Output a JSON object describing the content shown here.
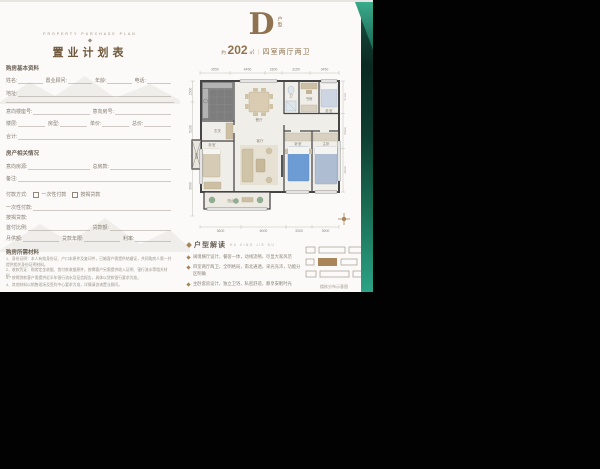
{
  "page": {
    "background": "#fbfaf8",
    "backdrop": "#020202",
    "accent_teal_dark": "#0a2921",
    "accent_teal_bright": "#2ca487",
    "accent_gold": "#a8865a"
  },
  "form": {
    "brand": "PROPERTY PURCHASE PLAN",
    "title": "置业计划表",
    "basic": {
      "section": "购房基本资料",
      "f_name": "姓名:",
      "f_consultant": "置业顾问:",
      "f_age": "年龄:",
      "f_phone": "电话:",
      "f_address": "地址:",
      "f_block": "意向楼座号:",
      "f_room": "意向房号:",
      "f_floor": "楼层:",
      "f_type": "房型:",
      "f_unitprice": "单价:",
      "f_total": "总价:",
      "f_sum": "合计:"
    },
    "property": {
      "section": "房产相关情况",
      "f_intent": "意向房源:",
      "f_amount": "总房款:",
      "f_note": "备注:"
    },
    "payment": {
      "label": "付款方式:",
      "opt1": "一次性付款",
      "opt2": "按揭贷款",
      "lump": "一次性付款:",
      "mortgage": "按揭贷款:",
      "f_downpay": "首付比例:",
      "f_loan": "贷款额:",
      "f_monthly": "月供额:",
      "f_years": "贷款年限:",
      "f_rate": "利率:"
    },
    "materials": {
      "section": "购房所需材料",
      "items": [
        "1、身份证明：本人有效身份证、户口本原件及复印件，已婚客户需提供结婚证，共同购房人需一并提供相关身份证明材料。",
        "2、收款凭证：购房定金收据、首付款收据原件，按揭客户另需提供收入证明、银行流水等相关材料。",
        "3、按揭贷款客户需提供近半年银行流水及征信报告，具体以贷款银行要求为准。",
        "4、其他材料以销售现场及签约中心要求为准，详情请咨询置业顾问。"
      ]
    }
  },
  "hero": {
    "letter": "D",
    "suffix": "户型",
    "approx": "约",
    "area": "202",
    "unit": "㎡",
    "sep": "｜",
    "desc": "四室两厅两卫"
  },
  "plan": {
    "rooms": {
      "kitchen": "厨房",
      "dining": "餐厅",
      "bath1": "卫",
      "study": "书房",
      "bed1": "卧室",
      "living": "客厅",
      "bed2": "卧室",
      "master": "主卧",
      "bed3": "卧室",
      "entry": "玄关",
      "balcony": "阳台",
      "lift": "电梯"
    },
    "dims": {
      "top": [
        "3550",
        "4450",
        "1800",
        "3150",
        "3450"
      ],
      "bottom": [
        "3600",
        "6000",
        "3300",
        "3900"
      ],
      "left": [
        "1500",
        "5100",
        "3900"
      ],
      "right": [
        "2100",
        "3300",
        "4500"
      ]
    }
  },
  "interpret": {
    "title": "户型解读",
    "sub": "HU XING JIE DU",
    "bullets": [
      "阔境横厅设计，餐客一体，动线流畅，尽显大家风范",
      "四室两厅两卫，全明格局，南北通透，采光充沛，功能分区明确",
      "主卧套房设计，独立卫浴，私密舒适，静享安眠时光",
      "南向观景阳台，推窗见绿，阳光满溢诗意生活"
    ]
  },
  "keyplan": {
    "caption": "楼栋分布示意图"
  }
}
